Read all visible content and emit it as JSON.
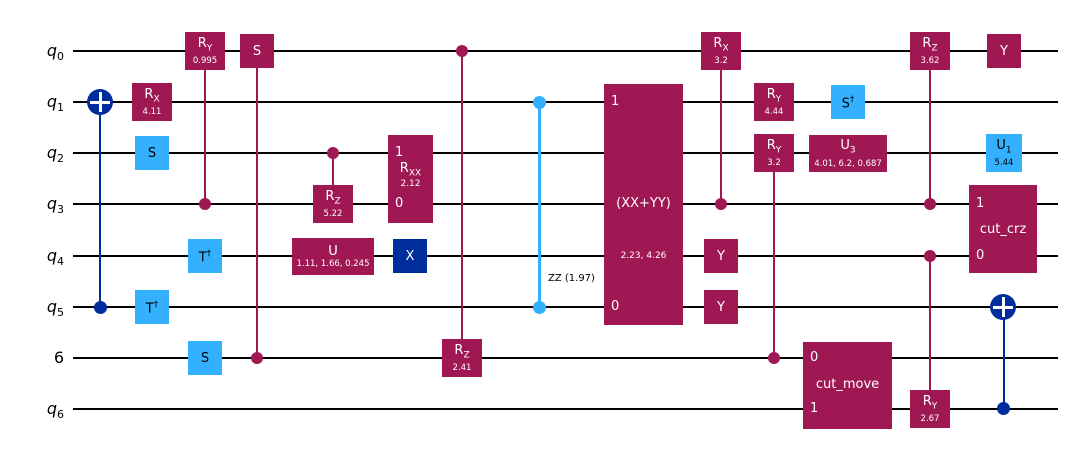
{
  "figure": {
    "type": "quantum-circuit-diagram",
    "background": "#ffffff"
  },
  "colors": {
    "rotation_gate": "#9F1853",
    "clifford_gate": "#33B1FF",
    "pauli_cnot": "#002D9C",
    "wire": "#000000",
    "gate_text_dark_bg": "#ffffff",
    "gate_text_light_bg": "#000000"
  },
  "wires": [
    {
      "label": "q",
      "sub": "0"
    },
    {
      "label": "q",
      "sub": "1"
    },
    {
      "label": "q",
      "sub": "2"
    },
    {
      "label": "q",
      "sub": "3"
    },
    {
      "label": "q",
      "sub": "4"
    },
    {
      "label": "q",
      "sub": "5"
    },
    {
      "label": "6",
      "sub": ""
    },
    {
      "label": "q",
      "sub": "6"
    }
  ],
  "gates": {
    "rx_q1": {
      "name": "R",
      "sub": "X",
      "param": "4.11"
    },
    "s_q2": {
      "name": "S"
    },
    "tdg_q5": {
      "name": "T",
      "sup": "†"
    },
    "ry_q0": {
      "name": "R",
      "sub": "Y",
      "param": "0.995"
    },
    "tdg_q4": {
      "name": "T",
      "sup": "†"
    },
    "s_w6": {
      "name": "S"
    },
    "cs_q0": {
      "name": "S"
    },
    "crz_q3": {
      "name": "R",
      "sub": "Z",
      "param": "5.22"
    },
    "u_q4": {
      "name": "U",
      "params": "1.11, 1.66, 0.245"
    },
    "rxx": {
      "top_index": "1",
      "bottom_index": "0",
      "name": "R",
      "sub": "XX",
      "param": "2.12"
    },
    "x_q4": {
      "name": "X"
    },
    "crz_w6": {
      "name": "R",
      "sub": "Z",
      "param": "2.41"
    },
    "zz": {
      "label": "ZZ (1.97)"
    },
    "xx_yy": {
      "top_index": "1",
      "bottom_index": "0",
      "name": "(XX+YY)",
      "params": "2.23, 4.26"
    },
    "crx_q0": {
      "name": "R",
      "sub": "X",
      "param": "3.2"
    },
    "y_q4": {
      "name": "Y"
    },
    "y_q5": {
      "name": "Y"
    },
    "ry_q1": {
      "name": "R",
      "sub": "Y",
      "param": "4.44"
    },
    "cry_q2": {
      "name": "R",
      "sub": "Y",
      "param": "3.2"
    },
    "sdg_q1": {
      "name": "S",
      "sup": "†"
    },
    "u3_q2": {
      "name": "U",
      "sub": "3",
      "params": "4.01, 6.2, 0.687"
    },
    "cut_move": {
      "top_index": "0",
      "bottom_index": "1",
      "label": "cut_move"
    },
    "crz2_q0": {
      "name": "R",
      "sub": "Z",
      "param": "3.62"
    },
    "cry_q6": {
      "name": "R",
      "sub": "Y",
      "param": "2.67"
    },
    "y_q0": {
      "name": "Y"
    },
    "u1_q2": {
      "name": "U",
      "sub": "1",
      "param": "5.44"
    },
    "cut_crz": {
      "top_index": "1",
      "bottom_index": "0",
      "label": "cut_crz"
    }
  }
}
